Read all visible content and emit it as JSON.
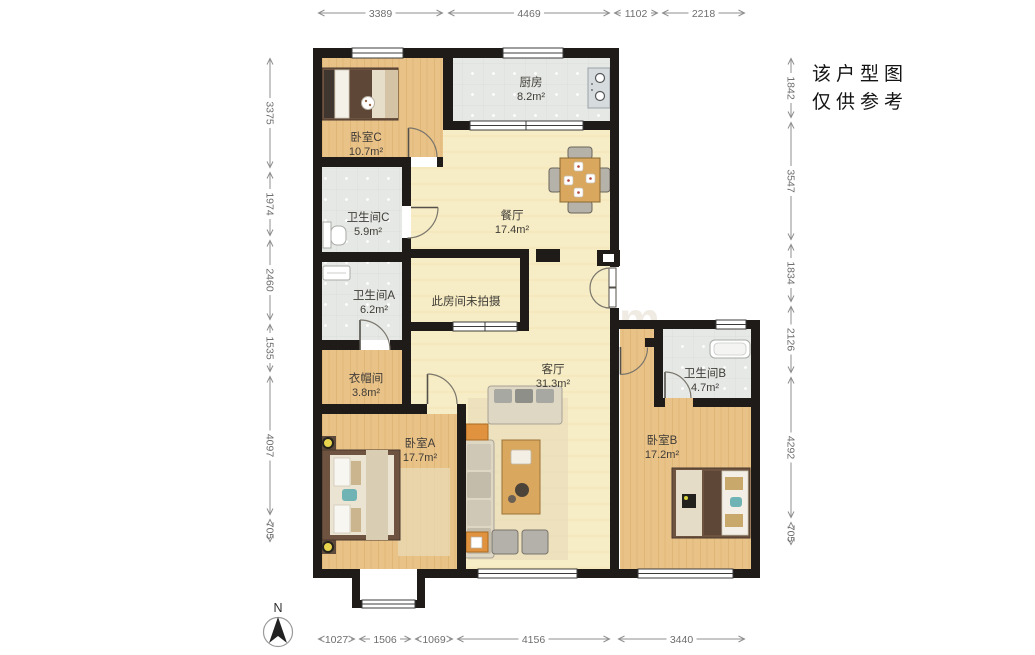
{
  "disclaimer": {
    "line1": "该户型图",
    "line2": "仅供参考"
  },
  "compass": {
    "label": "N"
  },
  "watermark": {
    "text": "lianjia.com"
  },
  "rooms": {
    "bedroom_c": {
      "name": "卧室C",
      "area": "10.7m²"
    },
    "kitchen": {
      "name": "厨房",
      "area": "8.2m²"
    },
    "bathroom_c": {
      "name": "卫生间C",
      "area": "5.9m²"
    },
    "dining": {
      "name": "餐厅",
      "area": "17.4m²"
    },
    "bathroom_a": {
      "name": "卫生间A",
      "area": "6.2m²"
    },
    "unphotographed": {
      "name": "此房间未拍摄"
    },
    "cloakroom": {
      "name": "衣帽间",
      "area": "3.8m²"
    },
    "living": {
      "name": "客厅",
      "area": "31.3m²"
    },
    "bathroom_b": {
      "name": "卫生间B",
      "area": "4.7m²"
    },
    "bedroom_a": {
      "name": "卧室A",
      "area": "17.7m²"
    },
    "bedroom_b": {
      "name": "卧室B",
      "area": "17.2m²"
    }
  },
  "dimensions": {
    "top": [
      "3389",
      "4469",
      "1102",
      "2218"
    ],
    "left": [
      "3375",
      "1974",
      "2460",
      "1535",
      "4097",
      "705"
    ],
    "right": [
      "1842",
      "3547",
      "1834",
      "2126",
      "4292",
      "705"
    ],
    "bottom": [
      "1027",
      "1506",
      "1069",
      "4156",
      "3440"
    ]
  }
}
